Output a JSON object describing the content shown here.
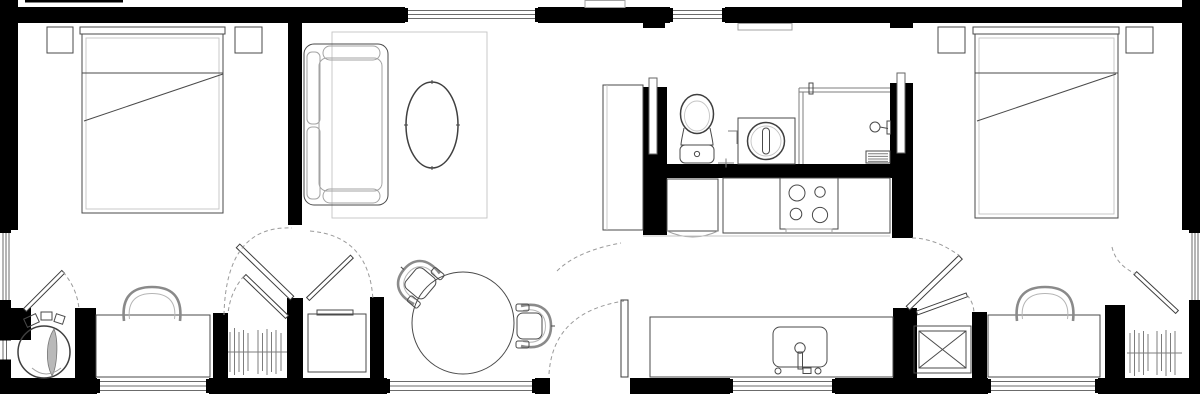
{
  "meta": {
    "type": "architectural-floor-plan",
    "description": "Top-down floor plan of a long rectangular dwelling with two end bedrooms, central bathroom and galley kitchen, living and dining areas",
    "visible_text": "",
    "canvas": {
      "width": 1200,
      "height": 401
    }
  },
  "palette": {
    "background": "#ffffff",
    "wall_fill": "#000000",
    "furniture_line": "#4a4a4a",
    "light_line": "#a3a3a3",
    "dashed_swing_line": "#9a9a9a"
  },
  "rooms": [
    {
      "name": "bedroom-left",
      "zone": "west end",
      "furniture": [
        "double-bed",
        "nightstand",
        "nightstand",
        "desk-with-chair",
        "wardrobe-closet",
        "round-lounge-chair-alcove"
      ]
    },
    {
      "name": "living-area",
      "zone": "west-center",
      "furniture": [
        "sofa",
        "area-rug",
        "oval-coffee-table",
        "tall-cabinet",
        "storage-niche-cabinet"
      ]
    },
    {
      "name": "dining-area",
      "zone": "center",
      "furniture": [
        "round-dining-table",
        "tub-chair",
        "tub-chair"
      ]
    },
    {
      "name": "bathroom",
      "zone": "center-north",
      "furniture": [
        "toilet",
        "washing-machine",
        "shower-enclosure",
        "shower-head",
        "floor-drain-grate",
        "wall-shelf"
      ]
    },
    {
      "name": "kitchen",
      "zone": "center",
      "furniture": [
        "refrigerator",
        "cooktop-4-burner",
        "upper-counter-run",
        "sink-counter-run",
        "kitchen-sink-with-faucet"
      ]
    },
    {
      "name": "bedroom-right",
      "zone": "east end",
      "furniture": [
        "double-bed",
        "nightstand",
        "nightstand",
        "desk-with-chair",
        "wardrobe-closet",
        "appliance-box-x"
      ]
    }
  ],
  "openings": {
    "windows": [
      {
        "wall": "top",
        "area": "living-area"
      },
      {
        "wall": "top",
        "area": "bath-hall"
      },
      {
        "wall": "left",
        "area": "bedroom-left"
      },
      {
        "wall": "left",
        "area": "chair-alcove"
      },
      {
        "wall": "right",
        "area": "bedroom-right"
      },
      {
        "wall": "bottom",
        "area": "desk-left"
      },
      {
        "wall": "bottom",
        "area": "dining-area"
      },
      {
        "wall": "bottom",
        "area": "kitchen-sink"
      },
      {
        "wall": "bottom",
        "area": "desk-right"
      }
    ],
    "doors": [
      {
        "type": "hinged-entry",
        "location": "bottom-center"
      },
      {
        "type": "pocket",
        "location": "bathroom-left"
      },
      {
        "type": "pocket",
        "location": "bathroom-right"
      },
      {
        "type": "hinged",
        "location": "bedroom-left-passage"
      },
      {
        "type": "hinged",
        "location": "closet-left"
      },
      {
        "type": "hinged",
        "location": "storage-niche"
      },
      {
        "type": "hinged",
        "location": "chair-alcove"
      },
      {
        "type": "hinged",
        "location": "bedroom-right-passage"
      },
      {
        "type": "hinged",
        "location": "appliance-closet"
      },
      {
        "type": "hinged",
        "location": "closet-right"
      }
    ]
  },
  "counts": {
    "bedrooms": 2,
    "beds": 2,
    "nightstands": 4,
    "closets": 2,
    "desks": 2,
    "dining_chairs": 2,
    "burners": 4
  }
}
